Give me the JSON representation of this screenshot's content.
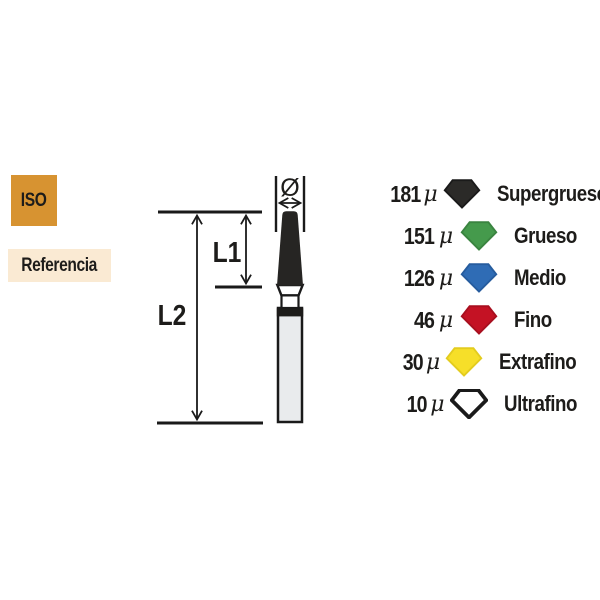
{
  "badges": {
    "iso": {
      "label": "ISO",
      "bg": "#D79331"
    },
    "referencia": {
      "label": "Referencia",
      "bg": "#FAEAD3"
    }
  },
  "diagram": {
    "labels": {
      "l1": "L1",
      "l2": "L2",
      "diameter": "Ø"
    },
    "head_color": "#262523",
    "shaft_color": "#E9EBED",
    "line_color": "#1a1a1a"
  },
  "legend": {
    "unit": "μ",
    "items": [
      {
        "value": "181",
        "label": "Supergrueso",
        "color": "#2B2A28",
        "outline": "#1a1a1a",
        "outline_width": 5
      },
      {
        "value": "151",
        "label": "Grueso",
        "color": "#459A4C",
        "outline": "#3A8440",
        "outline_width": 5
      },
      {
        "value": "126",
        "label": "Medio",
        "color": "#2F6CB5",
        "outline": "#265C9E",
        "outline_width": 5
      },
      {
        "value": "46",
        "label": "Fino",
        "color": "#C41224",
        "outline": "#A80F1F",
        "outline_width": 5
      },
      {
        "value": "30",
        "label": "Extrafino",
        "color": "#F6DF29",
        "outline": "#E3CC1E",
        "outline_width": 5
      },
      {
        "value": "10",
        "label": "Ultrafino",
        "color": "#FFFFFF",
        "outline": "#1a1a1a",
        "outline_width": 10
      }
    ]
  }
}
